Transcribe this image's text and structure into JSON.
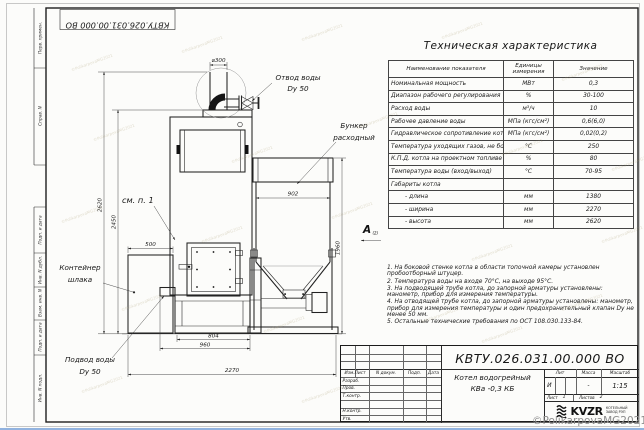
{
  "doc_number": "КВТУ.026.031.00.000  ВО",
  "margin_labels": [
    "Перв. примен.",
    "Справ. N",
    "Подп. и дата",
    "Инв. N дубл.",
    "Взам. инв. N",
    "Подп. и дата",
    "Инв. N подл."
  ],
  "drawing": {
    "dim_labels": {
      "chimney_dia": "⌀300",
      "height_total": "2620",
      "height_boiler": "2450",
      "container_width": "500",
      "bunker_width": "902",
      "bunker_height": "1960",
      "base_width": "804",
      "boiler_width": "960",
      "total_width": "2270"
    },
    "callouts": {
      "outlet_line1": "Отвод воды",
      "outlet_line2": "Dy 50",
      "bunker_line1": "Бункер",
      "bunker_line2": "расходный",
      "container_line1": "Контейнер",
      "container_line2": "шлака",
      "inlet_line1": "Подвод воды",
      "inlet_line2": "Dy 50",
      "see_item": "см. п. 1",
      "view_letter": "А",
      "view_ref": "(2)"
    }
  },
  "spec_table": {
    "title": "Техническая характеристика",
    "headers": {
      "name": "Наименование показателя",
      "units": "Единицы измерения",
      "value": "Значение"
    },
    "rows": [
      {
        "name": "Номинальная мощность",
        "units": "МВт",
        "value": "0,3"
      },
      {
        "name": "Диапазон рабочего регулирования",
        "units": "%",
        "value": "30-100"
      },
      {
        "name": "Расход воды",
        "units": "м³/ч",
        "value": "10"
      },
      {
        "name": "Рабочее давление воды",
        "units": "МПа (кгс/см²)",
        "value": "0,6(6,0)"
      },
      {
        "name": "Гидравлическое сопротивление котла",
        "units": "МПа (кгс/см²)",
        "value": "0,02(0,2)"
      },
      {
        "name": "Температура уходящих газов, не более",
        "units": "°С",
        "value": "250"
      },
      {
        "name": "К.П.Д. котла на проектном топливе",
        "units": "%",
        "value": "80"
      },
      {
        "name": "Температура воды (вход/выход)",
        "units": "°С",
        "value": "70-95"
      },
      {
        "name": "Габариты котла",
        "units": "",
        "value": ""
      },
      {
        "name": "- длина",
        "units": "мм",
        "value": "1380"
      },
      {
        "name": "- ширина",
        "units": "мм",
        "value": "2270"
      },
      {
        "name": "- высота",
        "units": "мм",
        "value": "2620"
      }
    ]
  },
  "notes": [
    "1. На боковой стенке котла в области топочной камеры установлен пробоотборный штуцер.",
    "2. Температура воды на входе 70°С, на выходе 95°С.",
    "3. На подводящей трубе котла, до запорной арматуры установлены: манометр, прибор для измерения температуры.",
    "4. На отводящей трубе котла, до запорной арматуры установлены: манометр, прибор для измерения температуры и один предохранительный клапан Dу не менее 50 мм.",
    "5. Остальные технические требования по ОСТ 108.030.133-84."
  ],
  "title_block": {
    "change_cols": {
      "izm": "Изм.Лист",
      "doc": "N докум.",
      "sign": "Подп.",
      "date": "Дата"
    },
    "roles": [
      "Разраб.",
      "Пров.",
      "Т.контр.",
      "",
      "Н.контр.",
      "Утв."
    ],
    "product_line1": "Котел водогрейный",
    "product_line2": "КВа -0,3  КБ",
    "lit_label": "Лит",
    "mass_label": "Масса",
    "scale_label": "Масштаб",
    "lit_value": "И",
    "mass_value": "-",
    "scale_value": "1:15",
    "sheet_label": "Лист",
    "sheet_value": "1",
    "sheets_label": "Листов",
    "sheets_value": "2",
    "logo_text": "KVZR",
    "logo_sub1": "КОТЕЛЬНЫЙ",
    "logo_sub2": "ЗАВОД РЭП"
  },
  "watermark": "©PolikarpovaMG2021"
}
